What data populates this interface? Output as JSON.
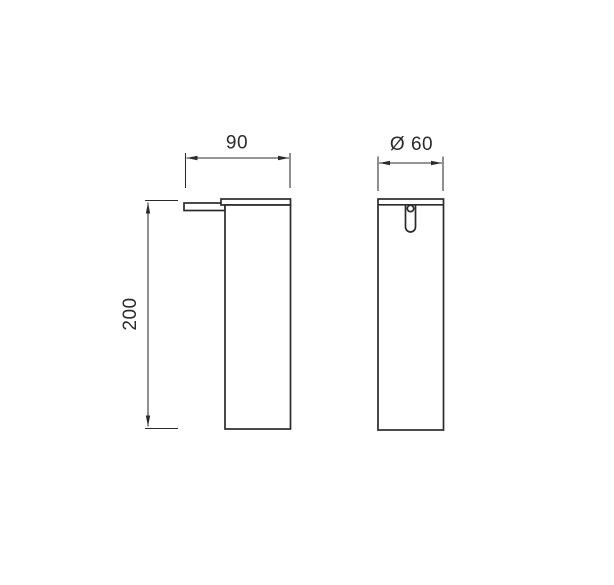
{
  "page": {
    "background": "#ffffff"
  },
  "drawing": {
    "kind": "technical-dimension-drawing",
    "colors": {
      "line": "#2b2b2b",
      "background": "#ffffff"
    },
    "dimensions": {
      "width": {
        "label": "90"
      },
      "diameter": {
        "label": "Ø 60"
      },
      "height": {
        "label": "200"
      }
    }
  }
}
